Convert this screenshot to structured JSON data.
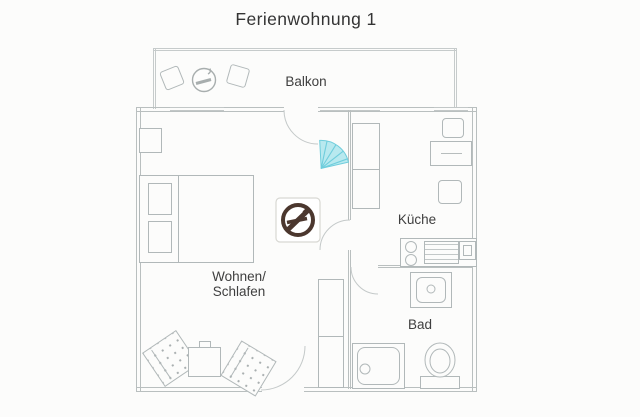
{
  "title": "Ferienwohnung 1",
  "rooms": {
    "balkon": "Balkon",
    "wohnen_line1": "Wohnen/",
    "wohnen_line2": "Schlafen",
    "kueche": "Küche",
    "bad": "Bad"
  },
  "colors": {
    "wall_line": "#b9bfbf",
    "furniture_line": "#b1b8b9",
    "label_text": "#3f3f3f",
    "no_smoking_sign": "#4b372e",
    "highlight_cyan_fill": "#b8e9ef",
    "highlight_cyan_stroke": "#6fcddc",
    "background": "#fcfcfb"
  }
}
